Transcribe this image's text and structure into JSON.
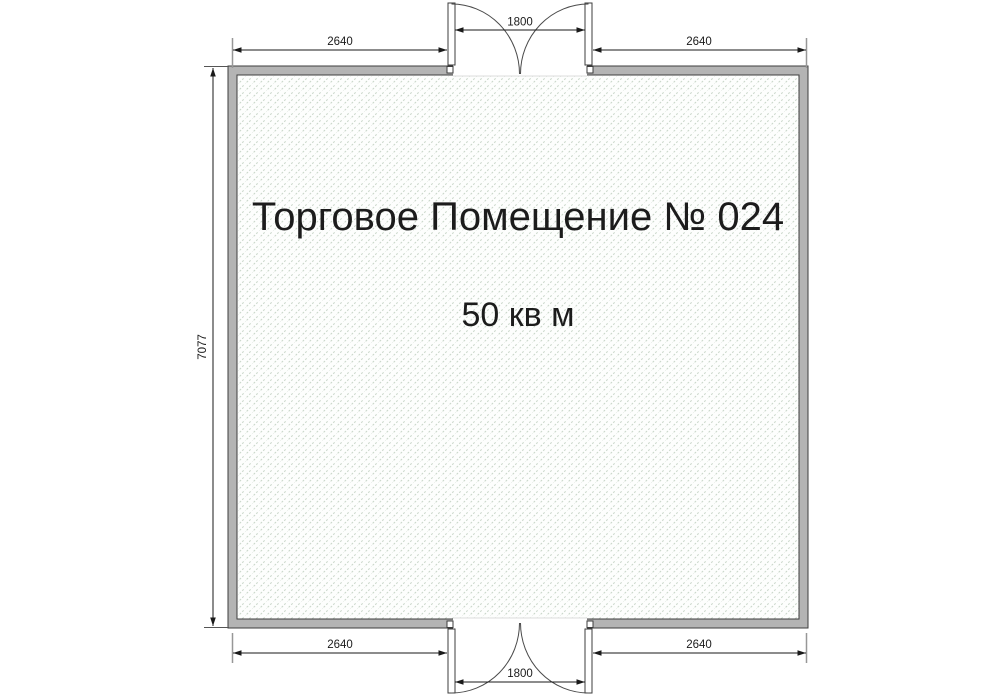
{
  "floorplan": {
    "room": {
      "title": "Торговое Помещение № 024",
      "area": "50 кв м"
    },
    "dimensions": {
      "top_left_width": "2640",
      "top_door_width": "1800",
      "top_right_width": "2640",
      "left_height": "7077",
      "bottom_left_width": "2640",
      "bottom_door_width": "1800",
      "bottom_right_width": "2640"
    },
    "colors": {
      "wall_fill": "#b4b4b4",
      "wall_outline": "#3e3e3e",
      "hatch_line": "#c9d6c9",
      "interior_background": "#fdfefd",
      "dimension_line": "#1a1a1a",
      "extension_tick": "#979797",
      "text": "#1c1c1c"
    }
  }
}
